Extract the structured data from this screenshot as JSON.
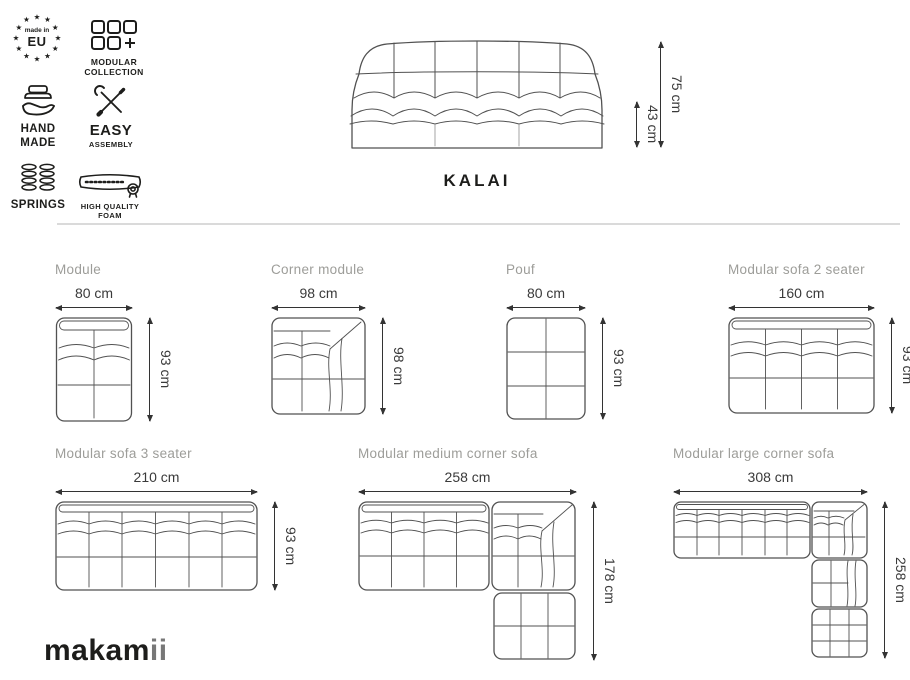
{
  "colors": {
    "line_art": "#515151",
    "dimension_text": "#3a3a3a",
    "label_gray": "#9d9d99",
    "divider": "#dadada",
    "logo_black": "#1d1d1b",
    "logo_gray": "#777777",
    "background": "#ffffff"
  },
  "badges": {
    "eu": {
      "star": "★",
      "line1": "made in",
      "line2": "EU"
    },
    "modular": {
      "line1": "MODULAR",
      "line2": "COLLECTION"
    },
    "handmade": {
      "line1": "HAND",
      "line2": "MADE"
    },
    "assembly": {
      "line1": "EASY",
      "line2": "ASSEMBLY"
    },
    "springs": {
      "label": "SPRINGS"
    },
    "foam": {
      "line1": "HIGH QUALITY",
      "line2": "FOAM"
    }
  },
  "hero": {
    "product_name": "KALAI",
    "total_height": "75 cm",
    "seat_height": "43 cm"
  },
  "diagrams": {
    "module": {
      "name": "Module",
      "width": "80 cm",
      "height": "93 cm"
    },
    "corner": {
      "name": "Corner module",
      "width": "98 cm",
      "height": "98 cm"
    },
    "pouf": {
      "name": "Pouf",
      "width": "80 cm",
      "height": "93 cm"
    },
    "sofa2": {
      "name": "Modular sofa 2 seater",
      "width": "160 cm",
      "height": "93 cm"
    },
    "sofa3": {
      "name": "Modular sofa 3 seater",
      "width": "210 cm",
      "height": "93 cm"
    },
    "medium": {
      "name": "Modular medium corner sofa",
      "width": "258 cm",
      "height": "178 cm"
    },
    "large": {
      "name": "Modular large corner sofa",
      "width": "308 cm",
      "height": "258 cm"
    }
  },
  "footer": {
    "logo_main": "makam",
    "logo_accent": "ii"
  }
}
